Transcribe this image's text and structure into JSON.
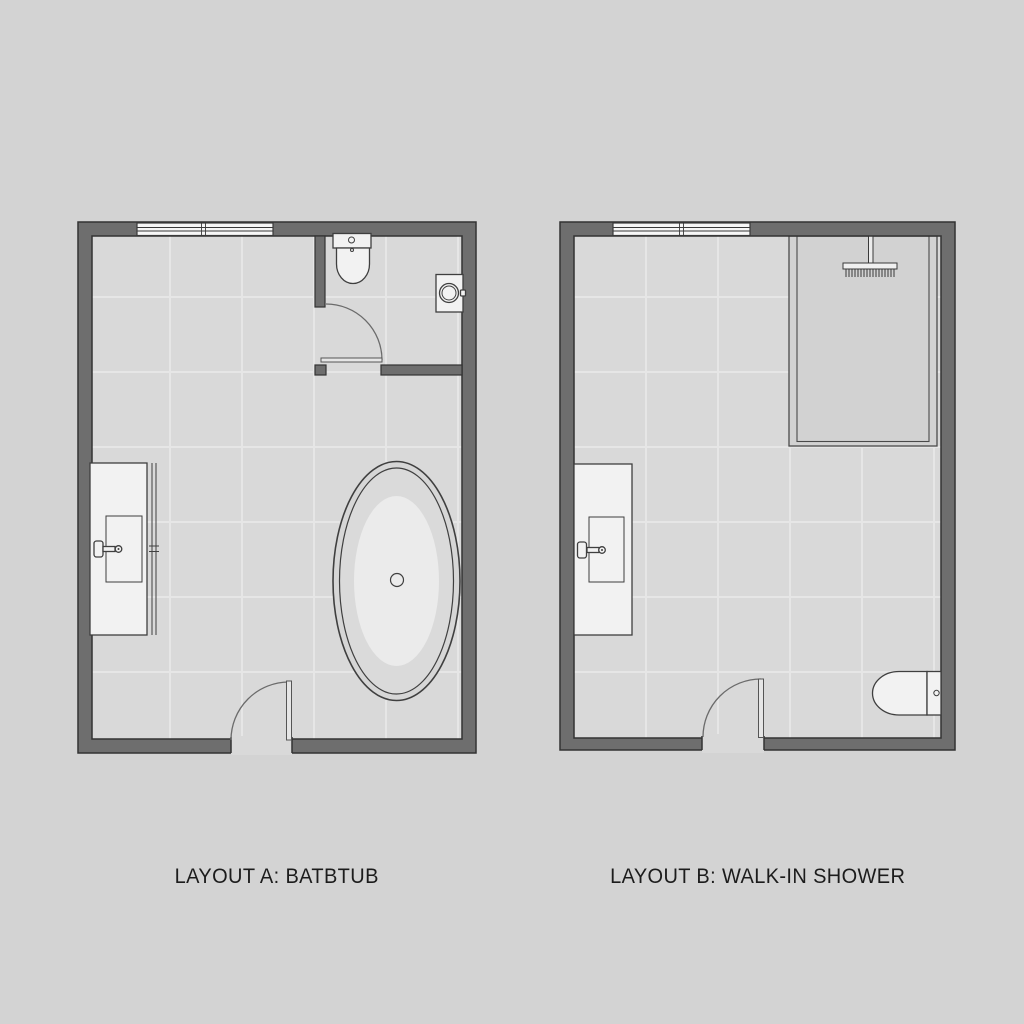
{
  "captions": {
    "layout_a": "LAYOUT A: BATBTUB",
    "layout_b": "LAYOUT B: WALK-IN SHOWER"
  },
  "colors": {
    "background": "#d3d3d3",
    "floor": "#d9d9d9",
    "grout": "#e6e6e6",
    "wall_fill": "#6e6e6e",
    "wall_outline": "#333333",
    "fixture_fill": "#f2f2f2",
    "fixture_outline": "#3f3f3f",
    "shower_floor": "#d2d2d2",
    "tub_basin": "#ebebeb",
    "arc_stroke": "#6b6b6b",
    "caption_text": "#1c1c1c"
  },
  "fixtures": {
    "plan_a": [
      "window",
      "toilet",
      "corner-sink",
      "wc-door",
      "vanity",
      "freestanding-bathtub",
      "entry-door"
    ],
    "plan_b": [
      "window",
      "walk-in-shower",
      "rain-shower-head",
      "vanity",
      "toilet",
      "entry-door"
    ]
  }
}
